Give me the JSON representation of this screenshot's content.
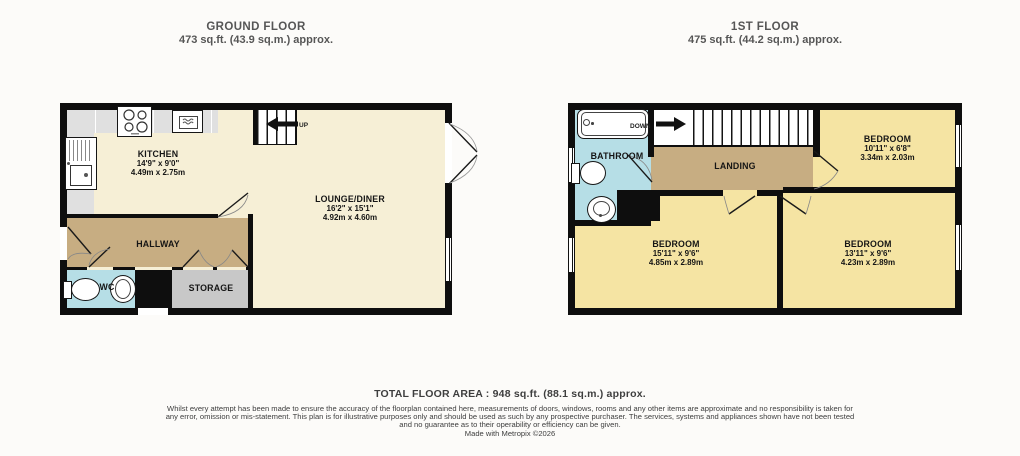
{
  "ground_floor": {
    "title": "GROUND FLOOR",
    "subtitle": "473 sq.ft. (43.9 sq.m.) approx.",
    "stairs_label": "UP",
    "rooms": {
      "kitchen": {
        "name": "KITCHEN",
        "dims_ft": "14'9\" x 9'0\"",
        "dims_m": "4.49m x 2.75m"
      },
      "lounge": {
        "name": "LOUNGE/DINER",
        "dims_ft": "16'2\" x 15'1\"",
        "dims_m": "4.92m x 4.60m"
      },
      "hallway": {
        "name": "HALLWAY"
      },
      "wc": {
        "name": "WC"
      },
      "storage": {
        "name": "STORAGE"
      }
    }
  },
  "first_floor": {
    "title": "1ST FLOOR",
    "subtitle": "475 sq.ft. (44.2 sq.m.) approx.",
    "stairs_label": "DOWN",
    "rooms": {
      "bathroom": {
        "name": "BATHROOM"
      },
      "landing": {
        "name": "LANDING"
      },
      "bedroom_top": {
        "name": "BEDROOM",
        "dims_ft": "10'11\" x 6'8\"",
        "dims_m": "3.34m x 2.03m"
      },
      "bedroom_left": {
        "name": "BEDROOM",
        "dims_ft": "15'11\" x 9'6\"",
        "dims_m": "4.85m x 2.89m"
      },
      "bedroom_right": {
        "name": "BEDROOM",
        "dims_ft": "13'11\" x 9'6\"",
        "dims_m": "4.23m x 2.89m"
      }
    }
  },
  "footer": {
    "total": "TOTAL FLOOR AREA : 948 sq.ft. (88.1 sq.m.) approx.",
    "disclaimer": "Whilst every attempt has been made to ensure the accuracy of the floorplan contained here, measurements of doors, windows, rooms and any other items are approximate and no responsibility is taken for any error, omission or mis-statement. This plan is for illustrative purposes only and should be used as such by any prospective purchaser. The services, systems and appliances shown have not been tested and no guarantee as to their operability or efficiency can be given.",
    "credit": "Made with Metropix ©2026"
  },
  "icons": {
    "ground_floor": [
      "hob-icon",
      "oven-icon",
      "sink-icon",
      "toilet-icon",
      "basin-icon",
      "up-arrow-icon"
    ],
    "first_floor": [
      "bathtub-icon",
      "toilet-icon",
      "basin-icon",
      "down-arrow-icon"
    ]
  },
  "colors": {
    "wall": "#0e0e0e",
    "floor_cream": "#f6efd6",
    "floor_yellow": "#f5e4a3",
    "hall_landing_tan": "#c7ad82",
    "wet_room_blue": "#b6dee6",
    "storage_gray": "#c8c8c8",
    "counter_gray": "#e0e0e0",
    "title_gray": "#565656"
  }
}
